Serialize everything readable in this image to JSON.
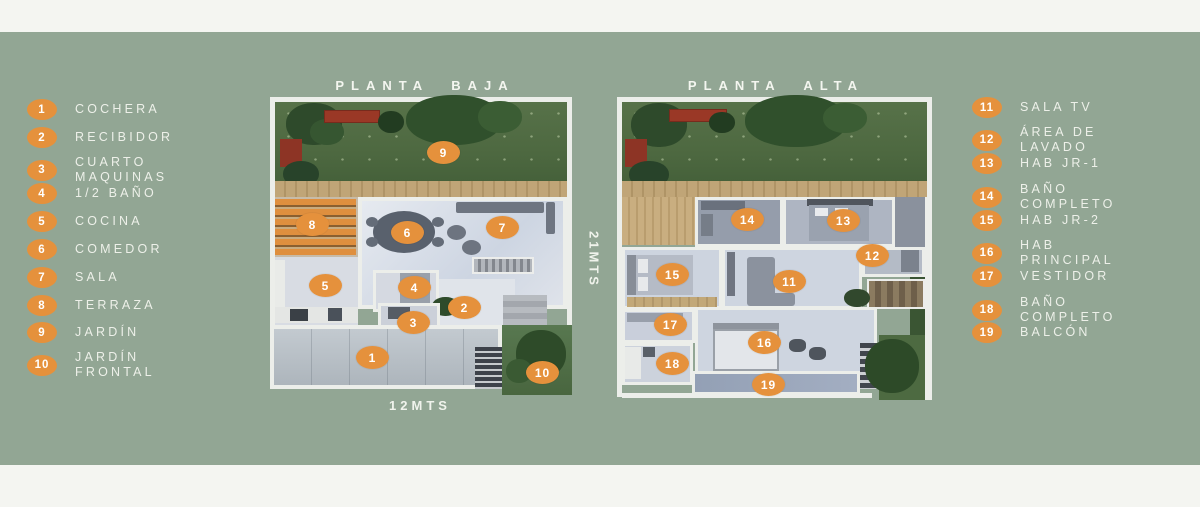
{
  "colors": {
    "background": "#92a694",
    "accent": "#e5913c",
    "band": "#f4f5f1"
  },
  "titles": {
    "plan_left": "PLANTA BAJA",
    "plan_right": "PLANTA ALTA"
  },
  "dimensions": {
    "width_label": "12MTS",
    "depth_label": "21MTS"
  },
  "legend_left": [
    {
      "num": "1",
      "label": "COCHERA"
    },
    {
      "num": "2",
      "label": "RECIBIDOR"
    },
    {
      "num": "3",
      "label": "CUARTO\nMAQUINAS"
    },
    {
      "num": "4",
      "label": "1/2 BAÑO"
    },
    {
      "num": "5",
      "label": "COCINA"
    },
    {
      "num": "6",
      "label": "COMEDOR"
    },
    {
      "num": "7",
      "label": "SALA"
    },
    {
      "num": "8",
      "label": "TERRAZA"
    },
    {
      "num": "9",
      "label": "JARDÍN"
    },
    {
      "num": "10",
      "label": "JARDÍN\nFRONTAL"
    }
  ],
  "legend_right": [
    {
      "num": "11",
      "label": "SALA TV"
    },
    {
      "num": "12",
      "label": "ÁREA DE\nLAVADO"
    },
    {
      "num": "13",
      "label": "HAB JR-1"
    },
    {
      "num": "14",
      "label": "BAÑO\nCOMPLETO"
    },
    {
      "num": "15",
      "label": "HAB JR-2"
    },
    {
      "num": "16",
      "label": "HAB\nPRINCIPAL"
    },
    {
      "num": "17",
      "label": "VESTIDOR"
    },
    {
      "num": "18",
      "label": "BAÑO\nCOMPLETO"
    },
    {
      "num": "19",
      "label": "BALCÓN"
    }
  ],
  "plan_baja_markers": [
    {
      "num": "1"
    },
    {
      "num": "2"
    },
    {
      "num": "3"
    },
    {
      "num": "4"
    },
    {
      "num": "5"
    },
    {
      "num": "6"
    },
    {
      "num": "7"
    },
    {
      "num": "8"
    },
    {
      "num": "9"
    },
    {
      "num": "10"
    }
  ],
  "plan_alta_markers": [
    {
      "num": "11"
    },
    {
      "num": "12"
    },
    {
      "num": "13"
    },
    {
      "num": "14"
    },
    {
      "num": "15"
    },
    {
      "num": "16"
    },
    {
      "num": "17"
    },
    {
      "num": "18"
    },
    {
      "num": "19"
    }
  ]
}
